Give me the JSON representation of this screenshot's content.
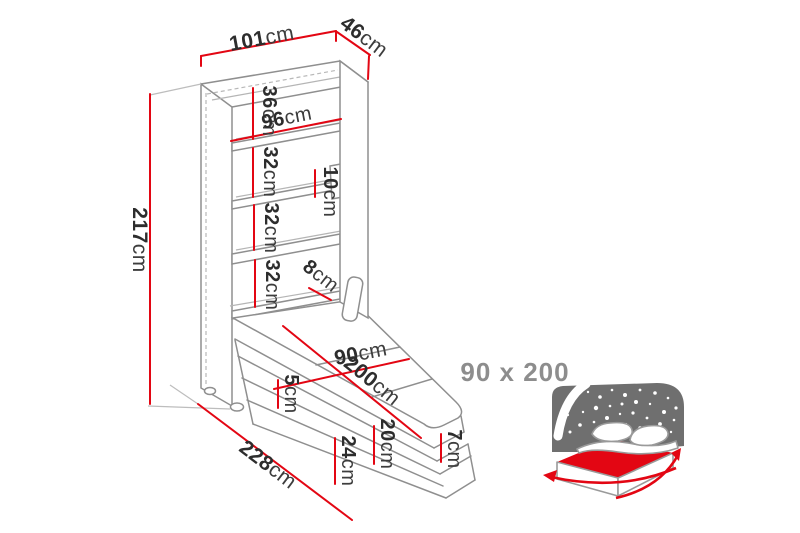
{
  "colors": {
    "dimension_red": "#e30613",
    "outline_gray": "#8f8f8f",
    "label_text": "#2d2d2d",
    "muted_gray": "#8d8d8d",
    "icon_dark_gray": "#6f6f6f"
  },
  "units": {
    "cm": "cm"
  },
  "dimensions": {
    "cabinet_width": {
      "v": "101"
    },
    "cabinet_depth": {
      "v": "46"
    },
    "top_compartment": {
      "v": "36"
    },
    "inner_width": {
      "v": "96"
    },
    "compartment_2": {
      "v": "32"
    },
    "rail_height": {
      "v": "10"
    },
    "compartment_3": {
      "v": "32"
    },
    "compartment_4": {
      "v": "32"
    },
    "bottom_clearance": {
      "v": "8"
    },
    "cabinet_height": {
      "v": "217"
    },
    "bed_width": {
      "v": "90"
    },
    "bed_length": {
      "v": "200"
    },
    "frame_rim": {
      "v": "5"
    },
    "mattress_thickness": {
      "v": "20"
    },
    "frame_depth": {
      "v": "24"
    },
    "platform_height": {
      "v": "7"
    },
    "total_projection": {
      "v": "228"
    }
  },
  "callout": {
    "size_label": "90 x 200"
  }
}
